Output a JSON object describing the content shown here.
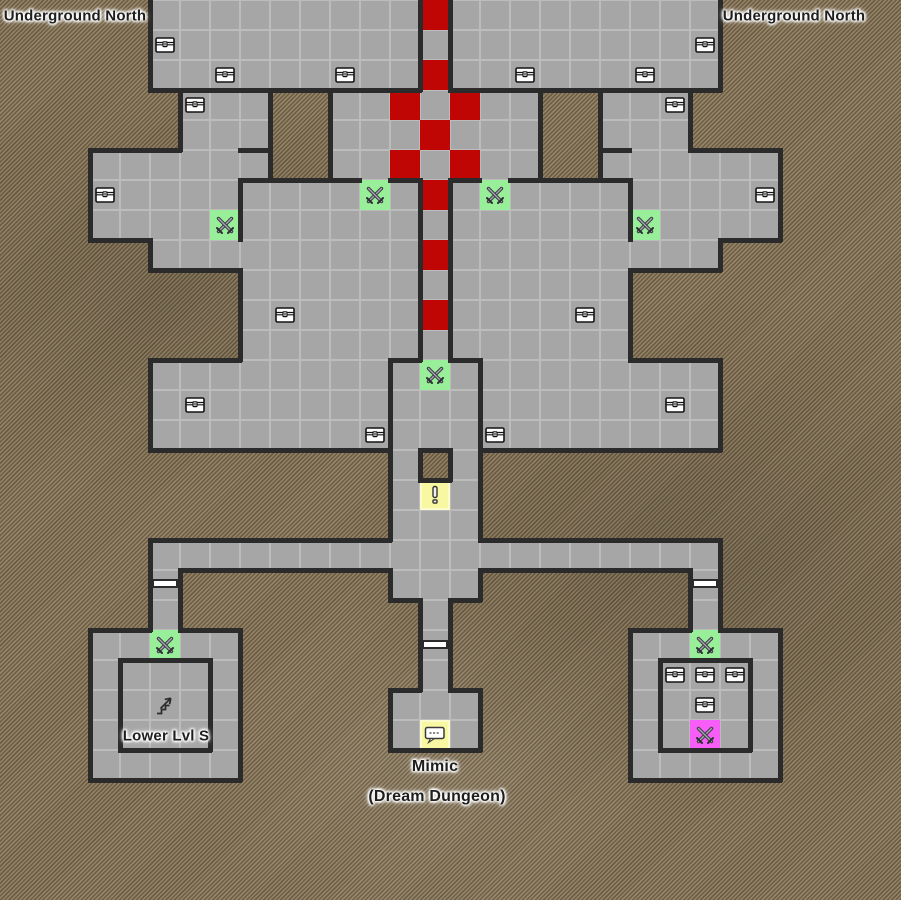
{
  "map": {
    "tile_size": 30,
    "grid": [
      ".....fffffffffRfffffffff......",
      ".....cfffffffffffffffffc......",
      ".....ffcfffcffRffcfffcff......",
      "......cff..ffRfRff..ffc.......",
      "......fff..fffRfff..fff.......",
      "...ffffff..ffRfRff..ffffff....",
      "...cffffffffgfRfgffffffffc....",
      "...ffffgfffffffffffffgffff....",
      ".....fffffffffRfffffffff......",
      "........fffffffffffff.........",
      "........fcffffRffffcf.........",
      "........fffffffffffff.........",
      ".....fffffffffgfffffffff......",
      ".....fcfffffffffffffffcf......",
      ".....fffffffcfffcfffffff......",
      ".............f.f..............",
      ".............fyf..............",
      ".............fff..............",
      ".....fffffffffffffffffff......",
      ".....f.......fff.......f......",
      ".....f........f........f......",
      "...ffgff......f......ffgff....",
      "...fffff......f......fcccf....",
      "...ffsff.....fff.....ffcff....",
      "...fffff.....fmf.....ffpff....",
      "...fffff.............fffff....",
      "..............................",
      "..............................",
      "..............................",
      ".............................."
    ],
    "legend": {
      ".": "void",
      "f": "floor",
      "c": "floor-with-chest",
      "s": "floor-with-stairs-up",
      "R": "red-path-tile",
      "g": "green-battle-tile",
      "p": "pink-boss-battle-tile",
      "y": "yellow-event-tile",
      "m": "yellow-mimic-dialog-tile"
    },
    "icon_names": [
      "chest-icon",
      "crossed-swords-icon",
      "stairs-up-icon",
      "exclamation-icon",
      "speech-bubble-icon"
    ],
    "icon_glyphs": {
      "exclamation": "!"
    },
    "internal_walls": [
      {
        "o": "h",
        "row": 3,
        "c0": 6,
        "c1": 8
      },
      {
        "o": "h",
        "row": 3,
        "c0": 11,
        "c1": 13
      },
      {
        "o": "h",
        "row": 3,
        "c0": 15,
        "c1": 17
      },
      {
        "o": "h",
        "row": 3,
        "c0": 20,
        "c1": 22
      },
      {
        "o": "h",
        "row": 5,
        "c0": 8,
        "c1": 8
      },
      {
        "o": "h",
        "row": 5,
        "c0": 20,
        "c1": 20
      },
      {
        "o": "h",
        "row": 6,
        "c0": 8,
        "c1": 8
      },
      {
        "o": "h",
        "row": 6,
        "c0": 11,
        "c1": 11
      },
      {
        "o": "h",
        "row": 6,
        "c0": 13,
        "c1": 13
      },
      {
        "o": "h",
        "row": 6,
        "c0": 15,
        "c1": 15
      },
      {
        "o": "h",
        "row": 6,
        "c0": 17,
        "c1": 17
      },
      {
        "o": "h",
        "row": 6,
        "c0": 20,
        "c1": 20
      },
      {
        "o": "h",
        "row": 12,
        "c0": 13,
        "c1": 13
      },
      {
        "o": "h",
        "row": 12,
        "c0": 15,
        "c1": 15
      },
      {
        "o": "h",
        "row": 22,
        "c0": 4,
        "c1": 6
      },
      {
        "o": "h",
        "row": 25,
        "c0": 4,
        "c1": 6
      },
      {
        "o": "h",
        "row": 22,
        "c0": 22,
        "c1": 24
      },
      {
        "o": "h",
        "row": 25,
        "c0": 22,
        "c1": 24
      },
      {
        "o": "v",
        "col": 14,
        "r0": 0,
        "r1": 2
      },
      {
        "o": "v",
        "col": 15,
        "r0": 0,
        "r1": 2
      },
      {
        "o": "v",
        "col": 14,
        "r0": 6,
        "r1": 11
      },
      {
        "o": "v",
        "col": 15,
        "r0": 6,
        "r1": 11
      },
      {
        "o": "v",
        "col": 8,
        "r0": 6,
        "r1": 7
      },
      {
        "o": "v",
        "col": 21,
        "r0": 6,
        "r1": 7
      },
      {
        "o": "v",
        "col": 13,
        "r0": 12,
        "r1": 14
      },
      {
        "o": "v",
        "col": 16,
        "r0": 12,
        "r1": 14
      },
      {
        "o": "v",
        "col": 4,
        "r0": 22,
        "r1": 24
      },
      {
        "o": "v",
        "col": 7,
        "r0": 22,
        "r1": 24
      },
      {
        "o": "v",
        "col": 22,
        "r0": 22,
        "r1": 24
      },
      {
        "o": "v",
        "col": 25,
        "r0": 22,
        "r1": 24
      }
    ],
    "doors": [
      {
        "x": 150,
        "y": 579
      },
      {
        "x": 690,
        "y": 579
      },
      {
        "x": 420,
        "y": 640
      }
    ],
    "colors": {
      "floor": "#a6a6a6",
      "wall": "#2b2b2b",
      "red": "#c00505",
      "green": "#99ef99",
      "yellow": "#f8f8a3",
      "pink": "#f75ef7",
      "bg": "#87775c",
      "bg_stripe_dark": "#6b5c42",
      "bg_stripe_light": "#948469",
      "door": "#ffffff",
      "grid_line": "rgba(255,255,255,0.25)",
      "label": "#1e1e1e"
    }
  },
  "labels": [
    {
      "text": "Underground North",
      "x": 75,
      "y": 16,
      "size": 15
    },
    {
      "text": "Underground North",
      "x": 794,
      "y": 16,
      "size": 15
    },
    {
      "text": "Lower Lvl S",
      "x": 166,
      "y": 736,
      "size": 15
    },
    {
      "text": "Mimic",
      "x": 435,
      "y": 767,
      "size": 16
    },
    {
      "text": "(Dream Dungeon)",
      "x": 437,
      "y": 797,
      "size": 16
    }
  ]
}
